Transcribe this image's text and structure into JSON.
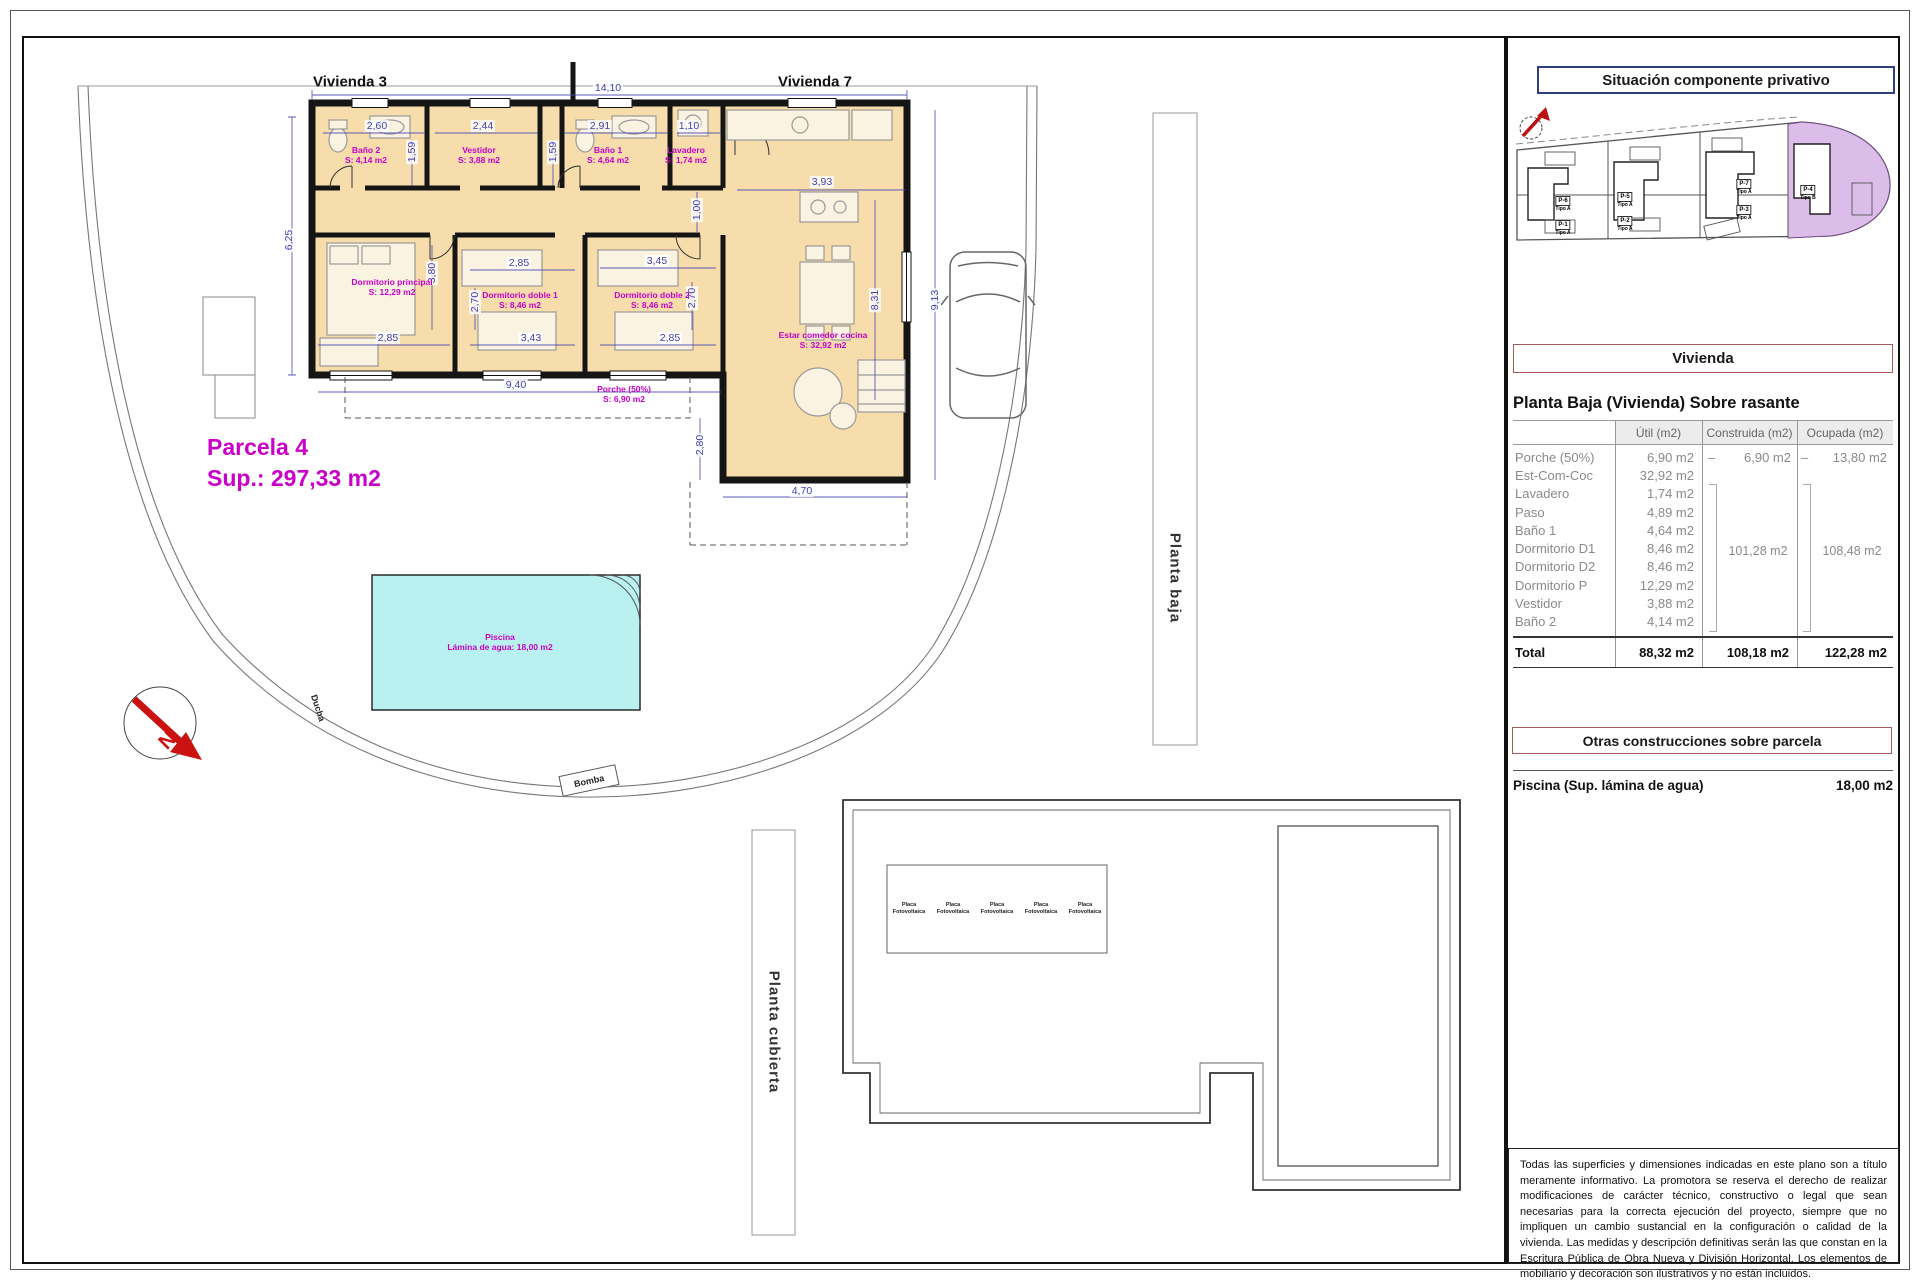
{
  "colors": {
    "magenta": "#c800c8",
    "dim_blue": "#4040ae",
    "pool_fill": "#b9f1f1",
    "room_fill": "#f6ddab",
    "highlight_parcel": "#dcbce8",
    "header_red_border": "#a85b5b",
    "title_navy_border": "#2e3f77",
    "north_red": "#cc1111"
  },
  "plan": {
    "vivienda3": "Vivienda 3",
    "vivienda7": "Vivienda 7",
    "parcela_name": "Parcela 4",
    "parcela_sup": "Sup.: 297,33 m2",
    "ducha": "Ducha",
    "bomba": "Bomba",
    "north_letter": "N",
    "planta_baja_band": "Planta baja",
    "planta_cubierta_band": "Planta cubierta",
    "dims": [
      {
        "v": "14,10",
        "x": 608,
        "y": 88,
        "r": 0
      },
      {
        "v": "2,60",
        "x": 377,
        "y": 126,
        "r": 0
      },
      {
        "v": "2,44",
        "x": 483,
        "y": 126,
        "r": 0
      },
      {
        "v": "2,91",
        "x": 600,
        "y": 126,
        "r": 0
      },
      {
        "v": "1,10",
        "x": 689,
        "y": 126,
        "r": 0
      },
      {
        "v": "1,59",
        "x": 412,
        "y": 152,
        "r": -90
      },
      {
        "v": "1,59",
        "x": 553,
        "y": 152,
        "r": -90
      },
      {
        "v": "3,93",
        "x": 822,
        "y": 182,
        "r": 0
      },
      {
        "v": "1,00",
        "x": 697,
        "y": 210,
        "r": -90
      },
      {
        "v": "6,25",
        "x": 289,
        "y": 240,
        "r": -90
      },
      {
        "v": "3,80",
        "x": 432,
        "y": 273,
        "r": -90
      },
      {
        "v": "2,85",
        "x": 519,
        "y": 263,
        "r": 0
      },
      {
        "v": "2,70",
        "x": 475,
        "y": 302,
        "r": -90
      },
      {
        "v": "3,45",
        "x": 657,
        "y": 261,
        "r": 0
      },
      {
        "v": "2,70",
        "x": 692,
        "y": 298,
        "r": -90
      },
      {
        "v": "8,31",
        "x": 875,
        "y": 300,
        "r": -90
      },
      {
        "v": "9,13",
        "x": 935,
        "y": 300,
        "r": -90
      },
      {
        "v": "2,85",
        "x": 388,
        "y": 338,
        "r": 0
      },
      {
        "v": "3,43",
        "x": 531,
        "y": 338,
        "r": 0
      },
      {
        "v": "2,85",
        "x": 670,
        "y": 338,
        "r": 0
      },
      {
        "v": "9,40",
        "x": 516,
        "y": 385,
        "r": 0
      },
      {
        "v": "2,80",
        "x": 700,
        "y": 445,
        "r": -90
      },
      {
        "v": "4,70",
        "x": 802,
        "y": 491,
        "r": 0
      }
    ],
    "rooms": [
      {
        "n": "Baño 2",
        "a": "S: 4,14 m2",
        "x": 366,
        "y": 155
      },
      {
        "n": "Vestidor",
        "a": "S: 3,88 m2",
        "x": 479,
        "y": 155
      },
      {
        "n": "Baño 1",
        "a": "S: 4,64 m2",
        "x": 608,
        "y": 155
      },
      {
        "n": "Lavadero",
        "a": "S: 1,74 m2",
        "x": 686,
        "y": 155
      },
      {
        "n": "Dormitorio principal",
        "a": "S: 12,29 m2",
        "x": 392,
        "y": 287
      },
      {
        "n": "Dormitorio doble 1",
        "a": "S: 8,46 m2",
        "x": 520,
        "y": 300
      },
      {
        "n": "Dormitorio doble 2",
        "a": "S: 8,46 m2",
        "x": 652,
        "y": 300
      },
      {
        "n": "Estar comedor cocina",
        "a": "S: 32,92 m2",
        "x": 823,
        "y": 340
      },
      {
        "n": "Porche (50%)",
        "a": "S: 6,90 m2",
        "x": 624,
        "y": 394
      },
      {
        "n": "Piscina",
        "a": "Lámina de agua: 18,00 m2",
        "x": 500,
        "y": 642
      }
    ]
  },
  "roof": {
    "panel_label": "Placa Fotovoltaica",
    "panel_count": 5
  },
  "sitemap": {
    "title": "Situación componente privativo",
    "parcels": [
      {
        "id": "P-6",
        "tipo": "Tipo A",
        "x": 1563,
        "y": 201
      },
      {
        "id": "P-1",
        "tipo": "Tipo A",
        "x": 1563,
        "y": 225
      },
      {
        "id": "P-5",
        "tipo": "Tipo A",
        "x": 1625,
        "y": 197
      },
      {
        "id": "P-2",
        "tipo": "Tipo A",
        "x": 1625,
        "y": 221
      },
      {
        "id": "P-7",
        "tipo": "Tipo A",
        "x": 1744,
        "y": 184
      },
      {
        "id": "P-3",
        "tipo": "Tipo A",
        "x": 1744,
        "y": 210
      },
      {
        "id": "P-4",
        "tipo": "Tipo B",
        "x": 1808,
        "y": 190
      }
    ]
  },
  "panel": {
    "vivienda_header": "Vivienda",
    "section_title": "Planta Baja (Vivienda) Sobre rasante",
    "col_headers": [
      "Útil (m2)",
      "Construida (m2)",
      "Ocupada (m2)"
    ],
    "rows": [
      {
        "label": "Porche (50%)",
        "util": "6,90 m2",
        "c_dash": "–",
        "c_val": "6,90 m2",
        "o_dash": "–",
        "o_val": "13,80 m2"
      },
      {
        "label": "Est-Com-Coc",
        "util": "32,92 m2"
      },
      {
        "label": "Lavadero",
        "util": "1,74 m2"
      },
      {
        "label": "Paso",
        "util": "4,89 m2"
      },
      {
        "label": "Baño 1",
        "util": "4,64 m2"
      },
      {
        "label": "Dormitorio D1",
        "util": "8,46 m2"
      },
      {
        "label": "Dormitorio D2",
        "util": "8,46 m2"
      },
      {
        "label": "Dormitorio P",
        "util": "12,29 m2"
      },
      {
        "label": "Vestidor",
        "util": "3,88 m2"
      },
      {
        "label": "Baño 2",
        "util": "4,14 m2"
      }
    ],
    "construida_group": "101,28 m2",
    "ocupada_group": "108,48 m2",
    "total": {
      "label": "Total",
      "util": "88,32 m2",
      "construida": "108,18 m2",
      "ocupada": "122,28 m2"
    },
    "otras_header": "Otras construcciones sobre parcela",
    "piscina_label": "Piscina (Sup. lámina de agua)",
    "piscina_value": "18,00 m2",
    "disclaimer": "Todas las superficies y dimensiones indicadas en este plano son a título meramente informativo. La promotora se reserva el derecho de realizar modificaciones de carácter técnico, constructivo o legal que sean necesarias para la correcta ejecución del proyecto, siempre que no impliquen un cambio sustancial en la configuración o calidad de la vivienda. Las medidas y descripción definitivas serán las que constan en la Escritura Pública de Obra Nueva y División Horizontal. Los elementos de mobiliario y decoración son ilustrativos y no están incluidos."
  }
}
